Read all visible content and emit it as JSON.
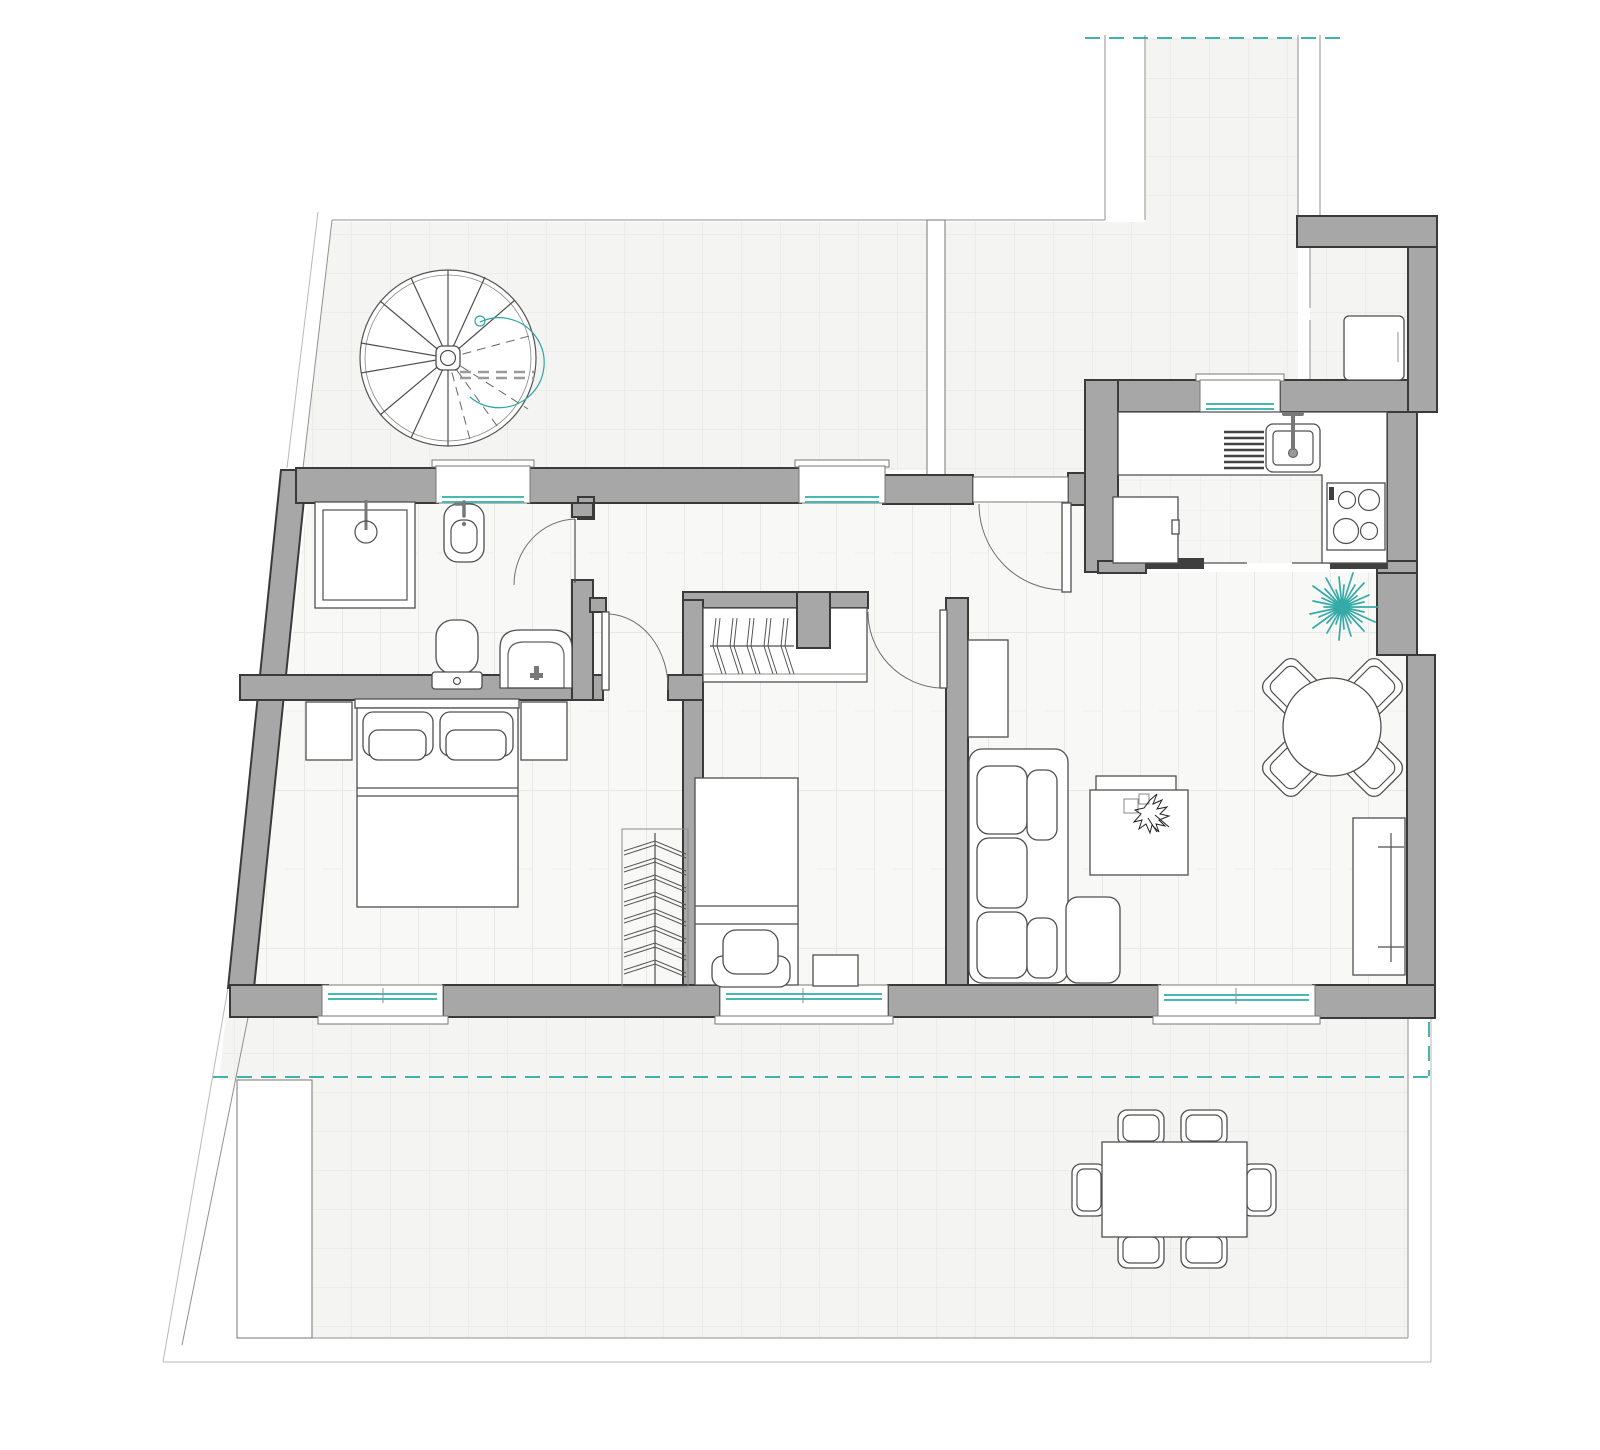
{
  "document": {
    "type": "architectural-floor-plan",
    "view": "top-down apartment plan with terraces",
    "visible_text": []
  },
  "palette": {
    "wall": "#a7a7a7",
    "wall_outline": "#3a3a3a",
    "line": "#909090",
    "furniture": "#4f4f4f",
    "glazing": "#49b8b4",
    "accent": "#2ba7a3",
    "detail_dark": "#3f3f3f",
    "floor_wood": "#f8f8f6",
    "floor_tile": "#f4f4f4"
  },
  "rooms": [
    {
      "id": "upper-terrace",
      "label": "Upper terrace",
      "floor": "tile",
      "furniture": [
        "spiral staircase"
      ]
    },
    {
      "id": "access-corridor",
      "label": "Access corridor",
      "floor": "tile",
      "furniture": []
    },
    {
      "id": "utility-niche",
      "label": "Utility niche",
      "floor": "tile",
      "furniture": [
        "washing machine"
      ]
    },
    {
      "id": "kitchen",
      "label": "Kitchen",
      "floor": "tile",
      "furniture": [
        "kitchen sink",
        "dish drainer",
        "cooktop 4 burners",
        "refrigerator",
        "sliding doors",
        "window"
      ]
    },
    {
      "id": "living-dining",
      "label": "Living / dining room",
      "floor": "wood",
      "furniture": [
        "L-shaped sofa",
        "coffee table with plant",
        "tv cabinet",
        "round dining table",
        "4 dining chairs",
        "radiator console",
        "potted plant",
        "entrance door",
        "window"
      ]
    },
    {
      "id": "hallway",
      "label": "Hallway",
      "floor": "wood",
      "furniture": [
        "window"
      ]
    },
    {
      "id": "bathroom",
      "label": "Bathroom",
      "floor": "wood",
      "furniture": [
        "shower",
        "bidet",
        "toilet",
        "washbasin",
        "window",
        "door"
      ]
    },
    {
      "id": "master-bedroom",
      "label": "Master bedroom",
      "floor": "wood",
      "furniture": [
        "double bed",
        "2 nightstands",
        "open clothes rack",
        "window",
        "door"
      ]
    },
    {
      "id": "single-bedroom",
      "label": "Single bedroom",
      "floor": "wood",
      "furniture": [
        "single bed",
        "armchair",
        "side table",
        "built-in closet with hangers",
        "window",
        "door"
      ]
    },
    {
      "id": "lower-terrace",
      "label": "Lower terrace",
      "floor": "tile",
      "furniture": [
        "outdoor dining table",
        "6 outdoor chairs",
        "planter"
      ]
    }
  ],
  "annotations": {
    "teal_dashed_lines": "property / section boundary lines",
    "teal_double_lines": "window glazing",
    "gray_fills": "load-bearing walls"
  }
}
